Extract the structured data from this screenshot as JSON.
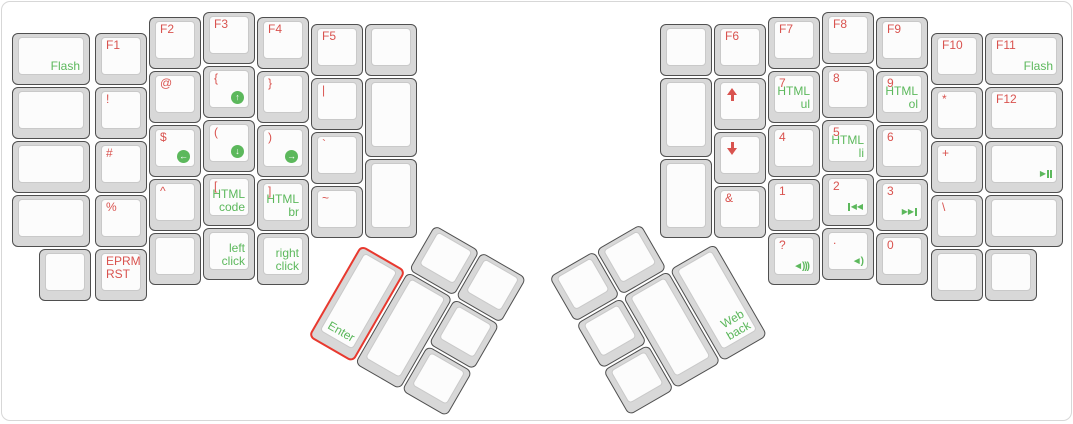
{
  "app": {
    "description": "ErgoDox keyboard layout – function/symbol/media layer",
    "colors": {
      "label_red": "#d9534f",
      "label_green": "#5cb85c",
      "selected_outline": "#e8392f",
      "cap_outer": "#d8d8d8",
      "cap_face": "#fcfcfc"
    }
  },
  "keys": {
    "left_main": [
      {
        "name": "key-flash",
        "br": "Flash"
      },
      {
        "name": "key-blank"
      },
      {
        "name": "key-blank"
      },
      {
        "name": "key-blank"
      },
      {
        "name": "key-blank"
      },
      {
        "name": "key-f1",
        "tl": "F1"
      },
      {
        "name": "key-exclamation",
        "tl": "!"
      },
      {
        "name": "key-hash",
        "tl": "#"
      },
      {
        "name": "key-percent",
        "tl": "%"
      },
      {
        "name": "key-eprm-rst",
        "tl": "EPRM\nRST"
      },
      {
        "name": "key-f2",
        "tl": "F2"
      },
      {
        "name": "key-at",
        "tl": "@"
      },
      {
        "name": "key-dollar",
        "tl": "$",
        "icon": "arrow-left-circle-icon"
      },
      {
        "name": "key-caret",
        "tl": "^"
      },
      {
        "name": "key-blank"
      },
      {
        "name": "key-f3",
        "tl": "F3"
      },
      {
        "name": "key-open-brace",
        "tl": "{",
        "icon": "arrow-up-circle-icon"
      },
      {
        "name": "key-open-paren",
        "tl": "(",
        "icon": "arrow-down-circle-icon"
      },
      {
        "name": "key-open-bracket",
        "tl": "[",
        "br": "HTML\ncode"
      },
      {
        "name": "key-left-click",
        "br": "left\nclick"
      },
      {
        "name": "key-f4",
        "tl": "F4"
      },
      {
        "name": "key-close-brace",
        "tl": "}"
      },
      {
        "name": "key-close-paren",
        "tl": ")",
        "icon": "arrow-right-circle-icon"
      },
      {
        "name": "key-close-bracket",
        "tl": "]",
        "br": "HTML\nbr"
      },
      {
        "name": "key-right-click",
        "br": "right\nclick"
      },
      {
        "name": "key-f5",
        "tl": "F5"
      },
      {
        "name": "key-pipe",
        "tl": "|"
      },
      {
        "name": "key-backtick",
        "tl": "`"
      },
      {
        "name": "key-tilde",
        "tl": "~"
      },
      {
        "name": "key-blank"
      },
      {
        "name": "key-blank"
      },
      {
        "name": "key-blank"
      }
    ],
    "left_thumb": [
      {
        "name": "key-blank"
      },
      {
        "name": "key-blank"
      },
      {
        "name": "key-enter",
        "bl": "Enter",
        "selected": true
      },
      {
        "name": "key-blank"
      },
      {
        "name": "key-blank"
      },
      {
        "name": "key-blank"
      }
    ],
    "right_main": [
      {
        "name": "key-blank"
      },
      {
        "name": "key-blank"
      },
      {
        "name": "key-blank"
      },
      {
        "name": "key-f6",
        "tl": "F6"
      },
      {
        "name": "key-arrow-up",
        "icon": "up-arrow-icon"
      },
      {
        "name": "key-arrow-down",
        "icon": "down-arrow-icon"
      },
      {
        "name": "key-ampersand",
        "tl": "&"
      },
      {
        "name": "key-f7",
        "tl": "F7"
      },
      {
        "name": "key-7",
        "tl": "7",
        "br": "HTML\nul"
      },
      {
        "name": "key-4",
        "tl": "4"
      },
      {
        "name": "key-1",
        "tl": "1"
      },
      {
        "name": "key-question",
        "tl": "?",
        "icon": "volume-up-icon"
      },
      {
        "name": "key-f8",
        "tl": "F8"
      },
      {
        "name": "key-8",
        "tl": "8"
      },
      {
        "name": "key-5",
        "tl": "5",
        "br": "HTML\nli"
      },
      {
        "name": "key-2",
        "tl": "2",
        "icon": "previous-track-icon"
      },
      {
        "name": "key-period",
        "tl": ".",
        "icon": "volume-down-icon"
      },
      {
        "name": "key-f9",
        "tl": "F9"
      },
      {
        "name": "key-9",
        "tl": "9",
        "br": "HTML\nol"
      },
      {
        "name": "key-6",
        "tl": "6"
      },
      {
        "name": "key-3",
        "tl": "3",
        "icon": "next-track-icon"
      },
      {
        "name": "key-0",
        "tl": "0"
      },
      {
        "name": "key-f10",
        "tl": "F10"
      },
      {
        "name": "key-asterisk",
        "tl": "*"
      },
      {
        "name": "key-plus",
        "tl": "+"
      },
      {
        "name": "key-backslash",
        "tl": "\\"
      },
      {
        "name": "key-blank"
      },
      {
        "name": "key-f11",
        "tl": "F11",
        "br": "Flash"
      },
      {
        "name": "key-f12",
        "tl": "F12"
      },
      {
        "name": "key-play-pause",
        "icon": "play-pause-icon"
      },
      {
        "name": "key-blank"
      },
      {
        "name": "key-blank"
      }
    ],
    "right_thumb": [
      {
        "name": "key-blank"
      },
      {
        "name": "key-blank"
      },
      {
        "name": "key-blank"
      },
      {
        "name": "key-blank"
      },
      {
        "name": "key-blank"
      },
      {
        "name": "key-web-back",
        "br": "Web\nback"
      }
    ]
  }
}
